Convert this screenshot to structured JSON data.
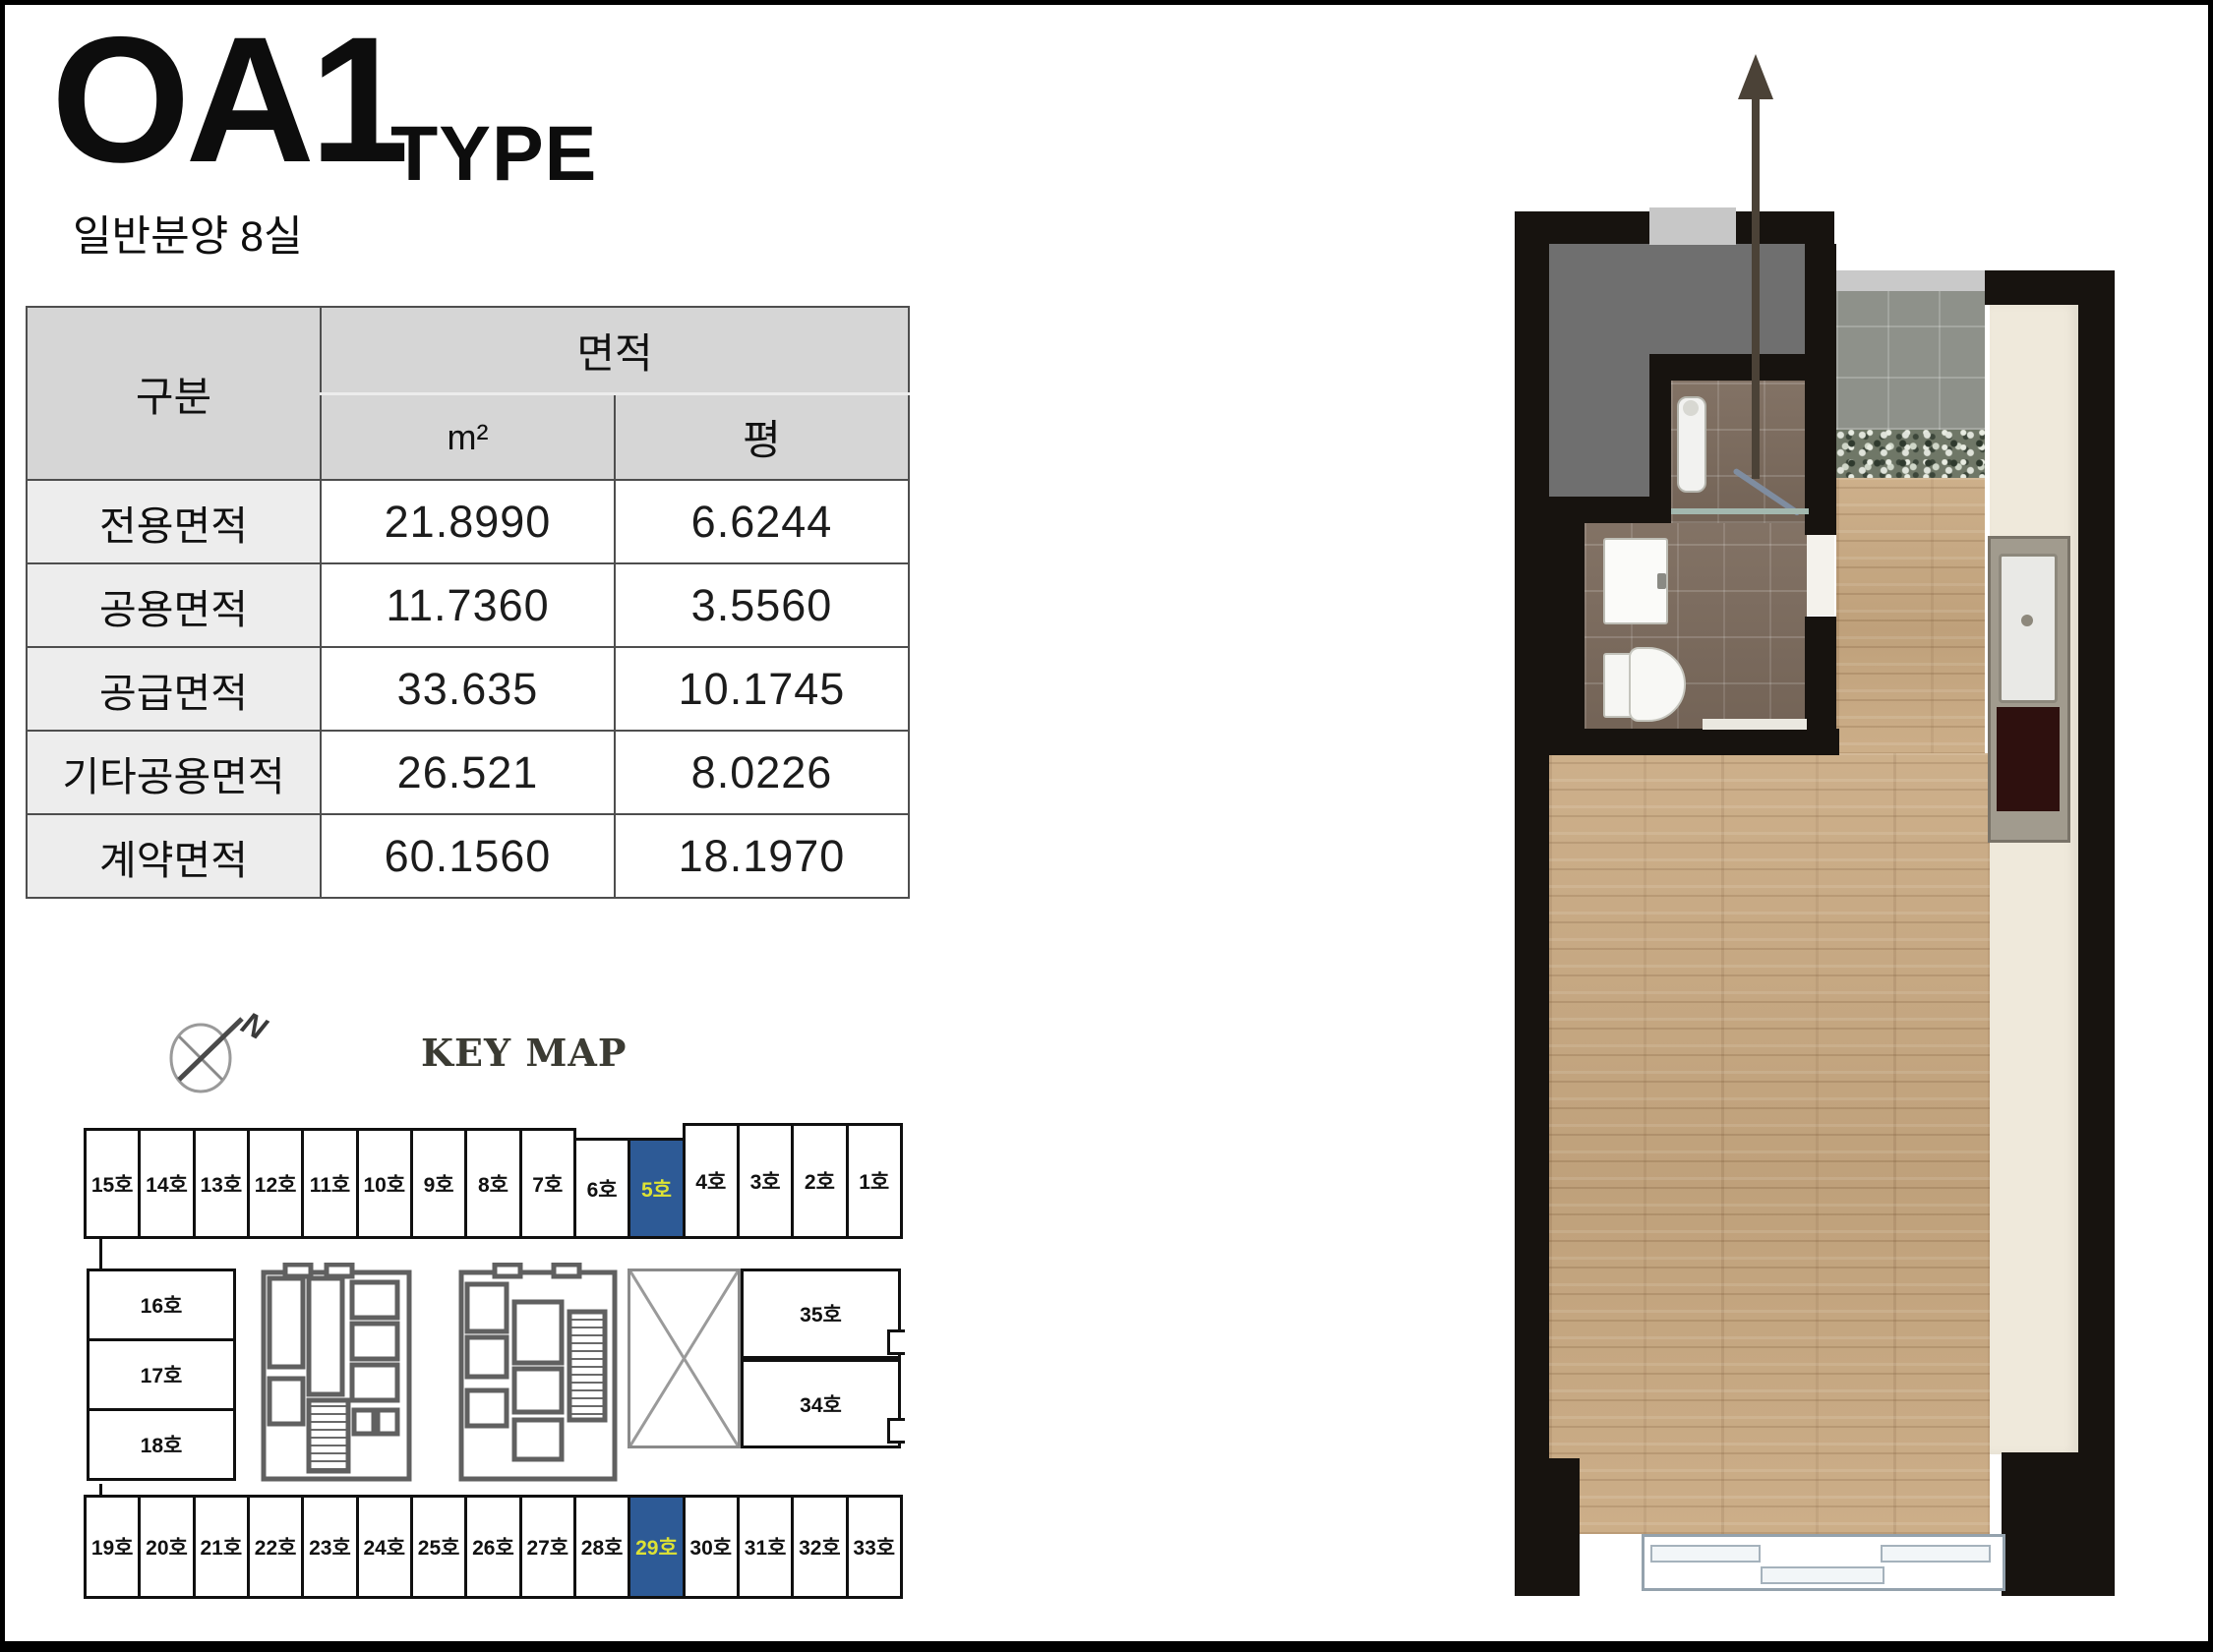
{
  "title": {
    "main": "OA1",
    "suffix": "TYPE",
    "subtitle": "일반분양 8실"
  },
  "area_table": {
    "header": {
      "category": "구분",
      "area": "면적",
      "m2": "m²",
      "pyeong": "평"
    },
    "rows": [
      {
        "label": "전용면적",
        "m2": "21.8990",
        "pyeong": "6.6244"
      },
      {
        "label": "공용면적",
        "m2": "11.7360",
        "pyeong": "3.5560"
      },
      {
        "label": "공급면적",
        "m2": "33.635",
        "pyeong": "10.1745"
      },
      {
        "label": "기타공용면적",
        "m2": "26.521",
        "pyeong": "8.0226"
      },
      {
        "label": "계약면적",
        "m2": "60.1560",
        "pyeong": "18.1970"
      }
    ]
  },
  "key_map": {
    "title": "KEY MAP",
    "compass_north_label": "N",
    "top_row": [
      "15호",
      "14호",
      "13호",
      "12호",
      "11호",
      "10호",
      "9호",
      "8호",
      "7호",
      "6호",
      "5호",
      "4호",
      "3호",
      "2호",
      "1호"
    ],
    "left_column": [
      "16호",
      "17호",
      "18호"
    ],
    "right_cells": [
      "35호",
      "34호"
    ],
    "bottom_row": [
      "19호",
      "20호",
      "21호",
      "22호",
      "23호",
      "24호",
      "25호",
      "26호",
      "27호",
      "28호",
      "29호",
      "30호",
      "31호",
      "32호",
      "33호"
    ],
    "highlighted_units": [
      "5호",
      "29호"
    ],
    "colors": {
      "highlight_bg": "#2d5a96",
      "highlight_text": "#dde234",
      "cell_border": "#101010"
    }
  },
  "floor_plan": {
    "colors": {
      "wall": "#17130f",
      "entry_floor": "#6f6f6f",
      "bath_tile": "#7c6b5d",
      "corridor_tile": "#8e918a",
      "pebble_band": "#6f7767",
      "wood_floor": "#c9a981",
      "balcony": "#efe9db",
      "stove": "#2e100e"
    }
  }
}
